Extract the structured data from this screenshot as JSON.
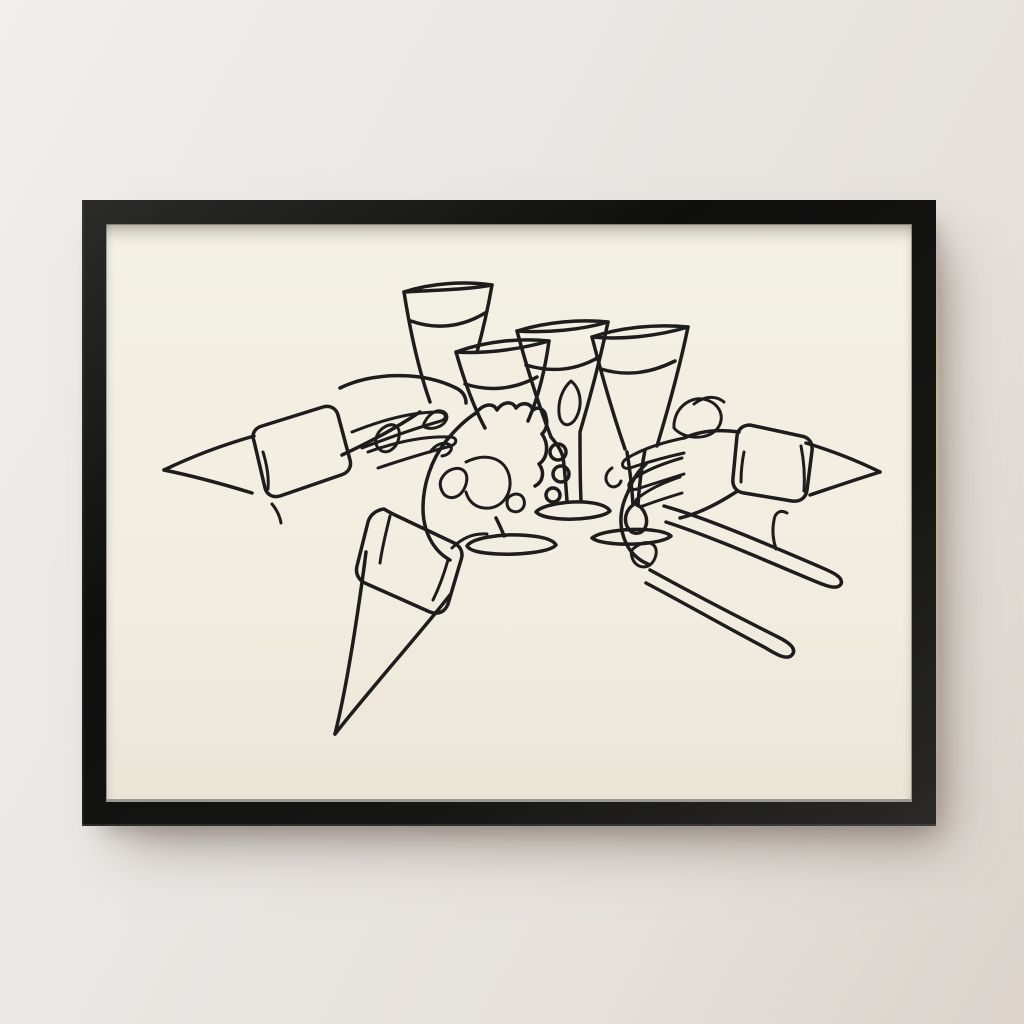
{
  "meta": {
    "description": "Photograph-style scene: a black picture frame hanging on a light wall, containing a cream art print of a continuous one-line ink drawing of hands in shirt cuffs raising four glasses in a toast."
  },
  "colors": {
    "wall_top": "#f0efed",
    "wall_mid": "#e9e6e3",
    "wall_bottom": "#dbd3cc",
    "frame": "#141413",
    "frame_edge_light": "#cdb392",
    "paper_top": "#f3f0e4",
    "paper_bottom": "#ebe5d6",
    "paper_lip": "#9b9995",
    "ink": "#1d1d1d",
    "shadow": "rgba(108,92,82,0.55)"
  },
  "artwork": {
    "subject": "Hands toasting with glasses",
    "style": "continuous single-line ink drawing on cream paper",
    "glasses": [
      "tumbler",
      "stemmed glass held by fist",
      "stemmed glass with gripped stem",
      "stemmed glass"
    ],
    "hands": [
      "left arm with cuff reaching to tumbler",
      "left fist with cuff gripping stem",
      "right arm with cuff holding right glass",
      "right hand with fingers extended down"
    ]
  }
}
